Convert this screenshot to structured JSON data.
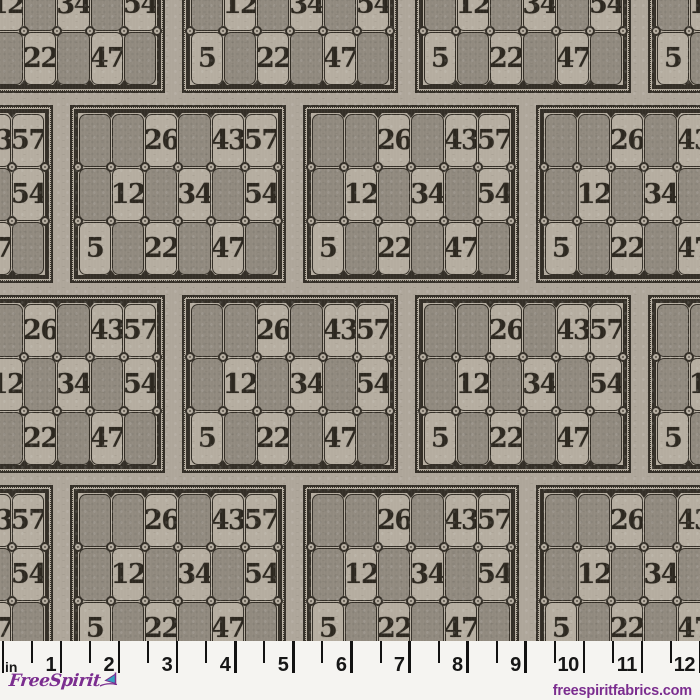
{
  "fabric": {
    "description": "Repeating vintage lotto / bingo card print on gray-taupe linen",
    "card_grid": [
      [
        "",
        "",
        "26",
        "",
        "43",
        "57"
      ],
      [
        "",
        "12",
        "",
        "34",
        "",
        "54"
      ],
      [
        "5",
        "",
        "22",
        "",
        "47",
        ""
      ]
    ],
    "card_numbers_visible": [
      "26",
      "43",
      "57",
      "12",
      "34",
      "54",
      "5",
      "22",
      "47"
    ]
  },
  "ruler": {
    "unit_label": "in",
    "inch_labels": [
      "1",
      "2",
      "3",
      "4",
      "5",
      "6",
      "7",
      "8",
      "9",
      "10",
      "11",
      "12"
    ]
  },
  "branding": {
    "logo_text": "FreeSpirit",
    "website": "freespiritfabrics.com"
  },
  "colors": {
    "cell_light": "#b5ada0",
    "cell_dark": "#918a7f",
    "ink": "#342f27",
    "background": "#aea69a",
    "ruler_background": "#f5f4f1",
    "tick": "#121212",
    "brand_purple": "#7b2d8f",
    "flag_teal": "#35a2c0"
  }
}
